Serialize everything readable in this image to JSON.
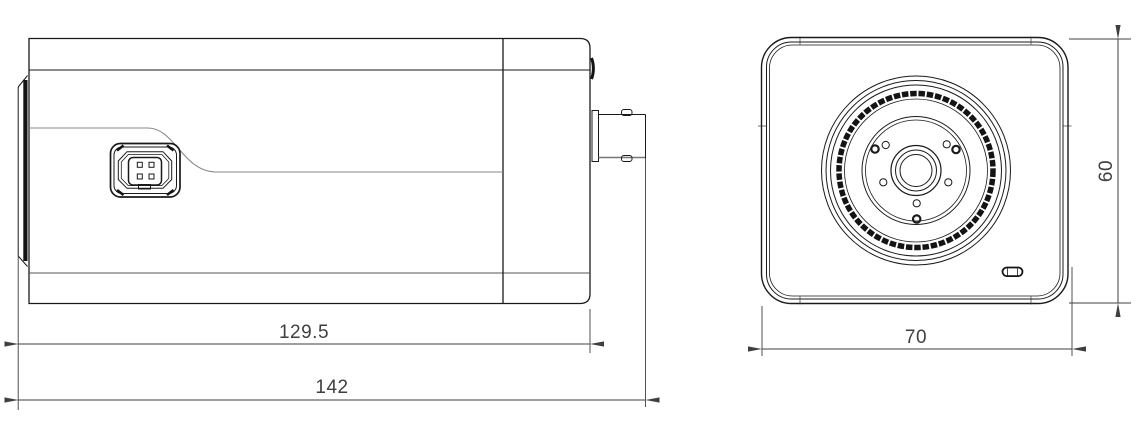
{
  "dimensions": {
    "body_length": "129.5",
    "total_length": "142",
    "front_width": "70",
    "front_height": "60"
  },
  "colors": {
    "line": "#1a1a1a",
    "soft_line": "#8a8a8a",
    "dark_detail": "#141414",
    "dimension": "#3f3f3f",
    "background": "#ffffff"
  }
}
